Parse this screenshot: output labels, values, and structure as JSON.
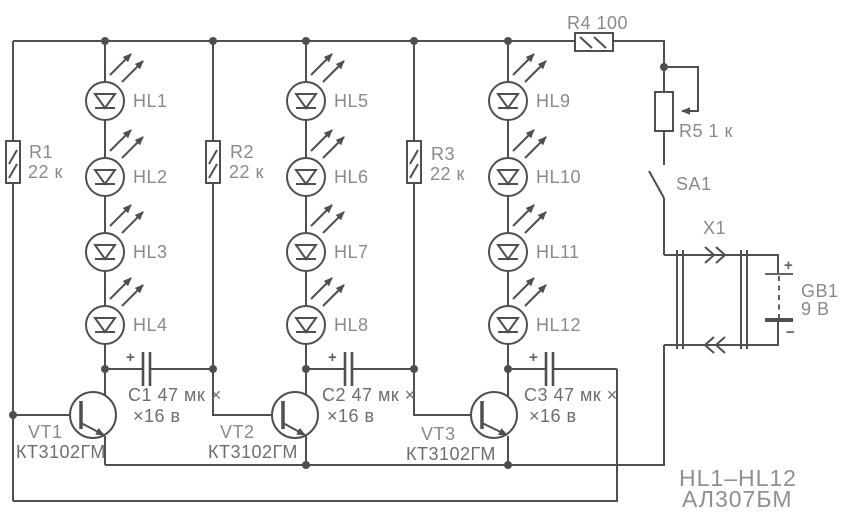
{
  "colors": {
    "background": "#ffffff",
    "wire": "#4f4f4f",
    "label": "#8a8a8a",
    "label_dark": "#6d6d6d"
  },
  "resistors": {
    "r1": {
      "ref": "R1",
      "value": "22 к"
    },
    "r2": {
      "ref": "R2",
      "value": "22 к"
    },
    "r3": {
      "ref": "R3",
      "value": "22 к"
    },
    "r4": {
      "label": "R4 100"
    },
    "r5": {
      "label": "R5 1 к"
    }
  },
  "leds": {
    "hl1": {
      "label": "HL1"
    },
    "hl2": {
      "label": "HL2"
    },
    "hl3": {
      "label": "HL3"
    },
    "hl4": {
      "label": "HL4"
    },
    "hl5": {
      "label": "HL5"
    },
    "hl6": {
      "label": "HL6"
    },
    "hl7": {
      "label": "HL7"
    },
    "hl8": {
      "label": "HL8"
    },
    "hl9": {
      "label": "HL9"
    },
    "hl10": {
      "label": "HL10"
    },
    "hl11": {
      "label": "HL11"
    },
    "hl12": {
      "label": "HL12"
    }
  },
  "transistors": {
    "vt1": {
      "ref": "VT1",
      "part": "КТ3102ГМ"
    },
    "vt2": {
      "ref": "VT2",
      "part": "КТ3102ГМ"
    },
    "vt3": {
      "ref": "VT3",
      "part": "КТ3102ГМ"
    }
  },
  "capacitors": {
    "c1": {
      "line1": "C1 47 мк ×",
      "line2": "×16 в",
      "polarity": "+"
    },
    "c2": {
      "line1": "C2 47 мк ×",
      "line2": "×16 в",
      "polarity": "+"
    },
    "c3": {
      "line1": "C3 47 мк ×",
      "line2": "×16 в",
      "polarity": "+"
    }
  },
  "switch": {
    "label": "SA1"
  },
  "connector": {
    "label": "X1"
  },
  "battery": {
    "ref": "GB1",
    "value": "9 В",
    "plus": "+",
    "minus": "−"
  },
  "note": {
    "line1": "HL1–HL12",
    "line2": "АЛ307БМ"
  }
}
